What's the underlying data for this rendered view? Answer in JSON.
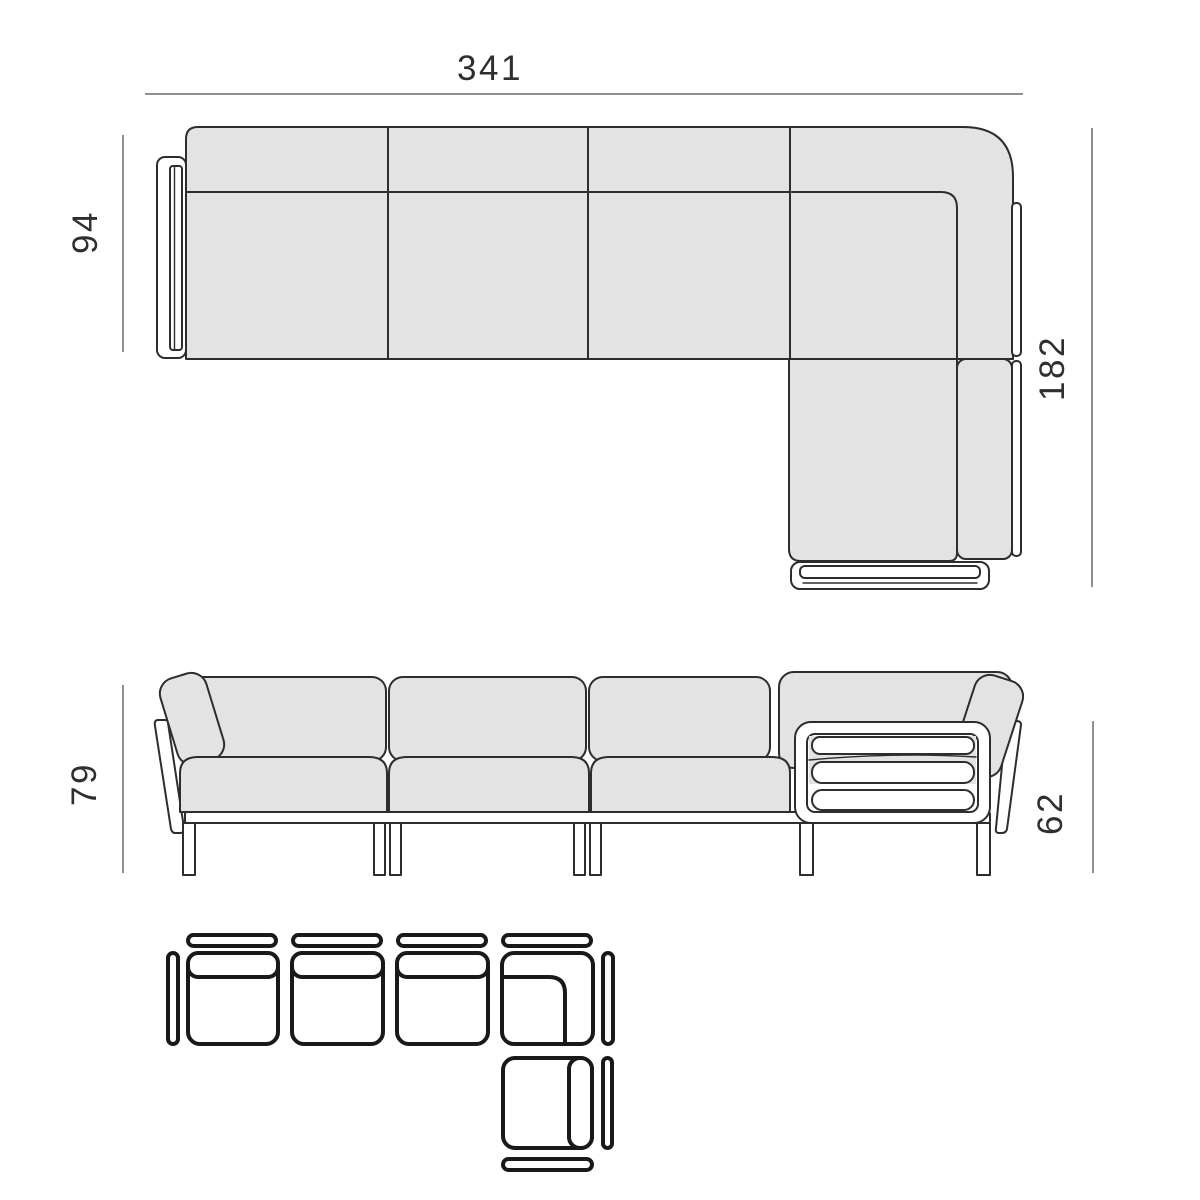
{
  "title": "modular-sofa-dimension-diagram",
  "colors": {
    "bg": "#ffffff",
    "cushion": "#e3e3e3",
    "line": "#2d2d2d",
    "dim": "#6a6a6a",
    "text": "#2f2f2f",
    "schematic": "#191919"
  },
  "views": {
    "top": {
      "name": "top-view-plan",
      "width_label": "341",
      "depth_label": "94",
      "chaise_depth_label": "182"
    },
    "front": {
      "name": "front-elevation",
      "height_label": "79",
      "frame_height_label": "62"
    },
    "schematic": {
      "name": "module-configuration",
      "modules": [
        "armrest-left",
        "seat-module-1",
        "seat-module-2",
        "seat-module-3",
        "corner-module",
        "chaise-end-module",
        "armrest-right",
        "armrest-end"
      ]
    }
  }
}
